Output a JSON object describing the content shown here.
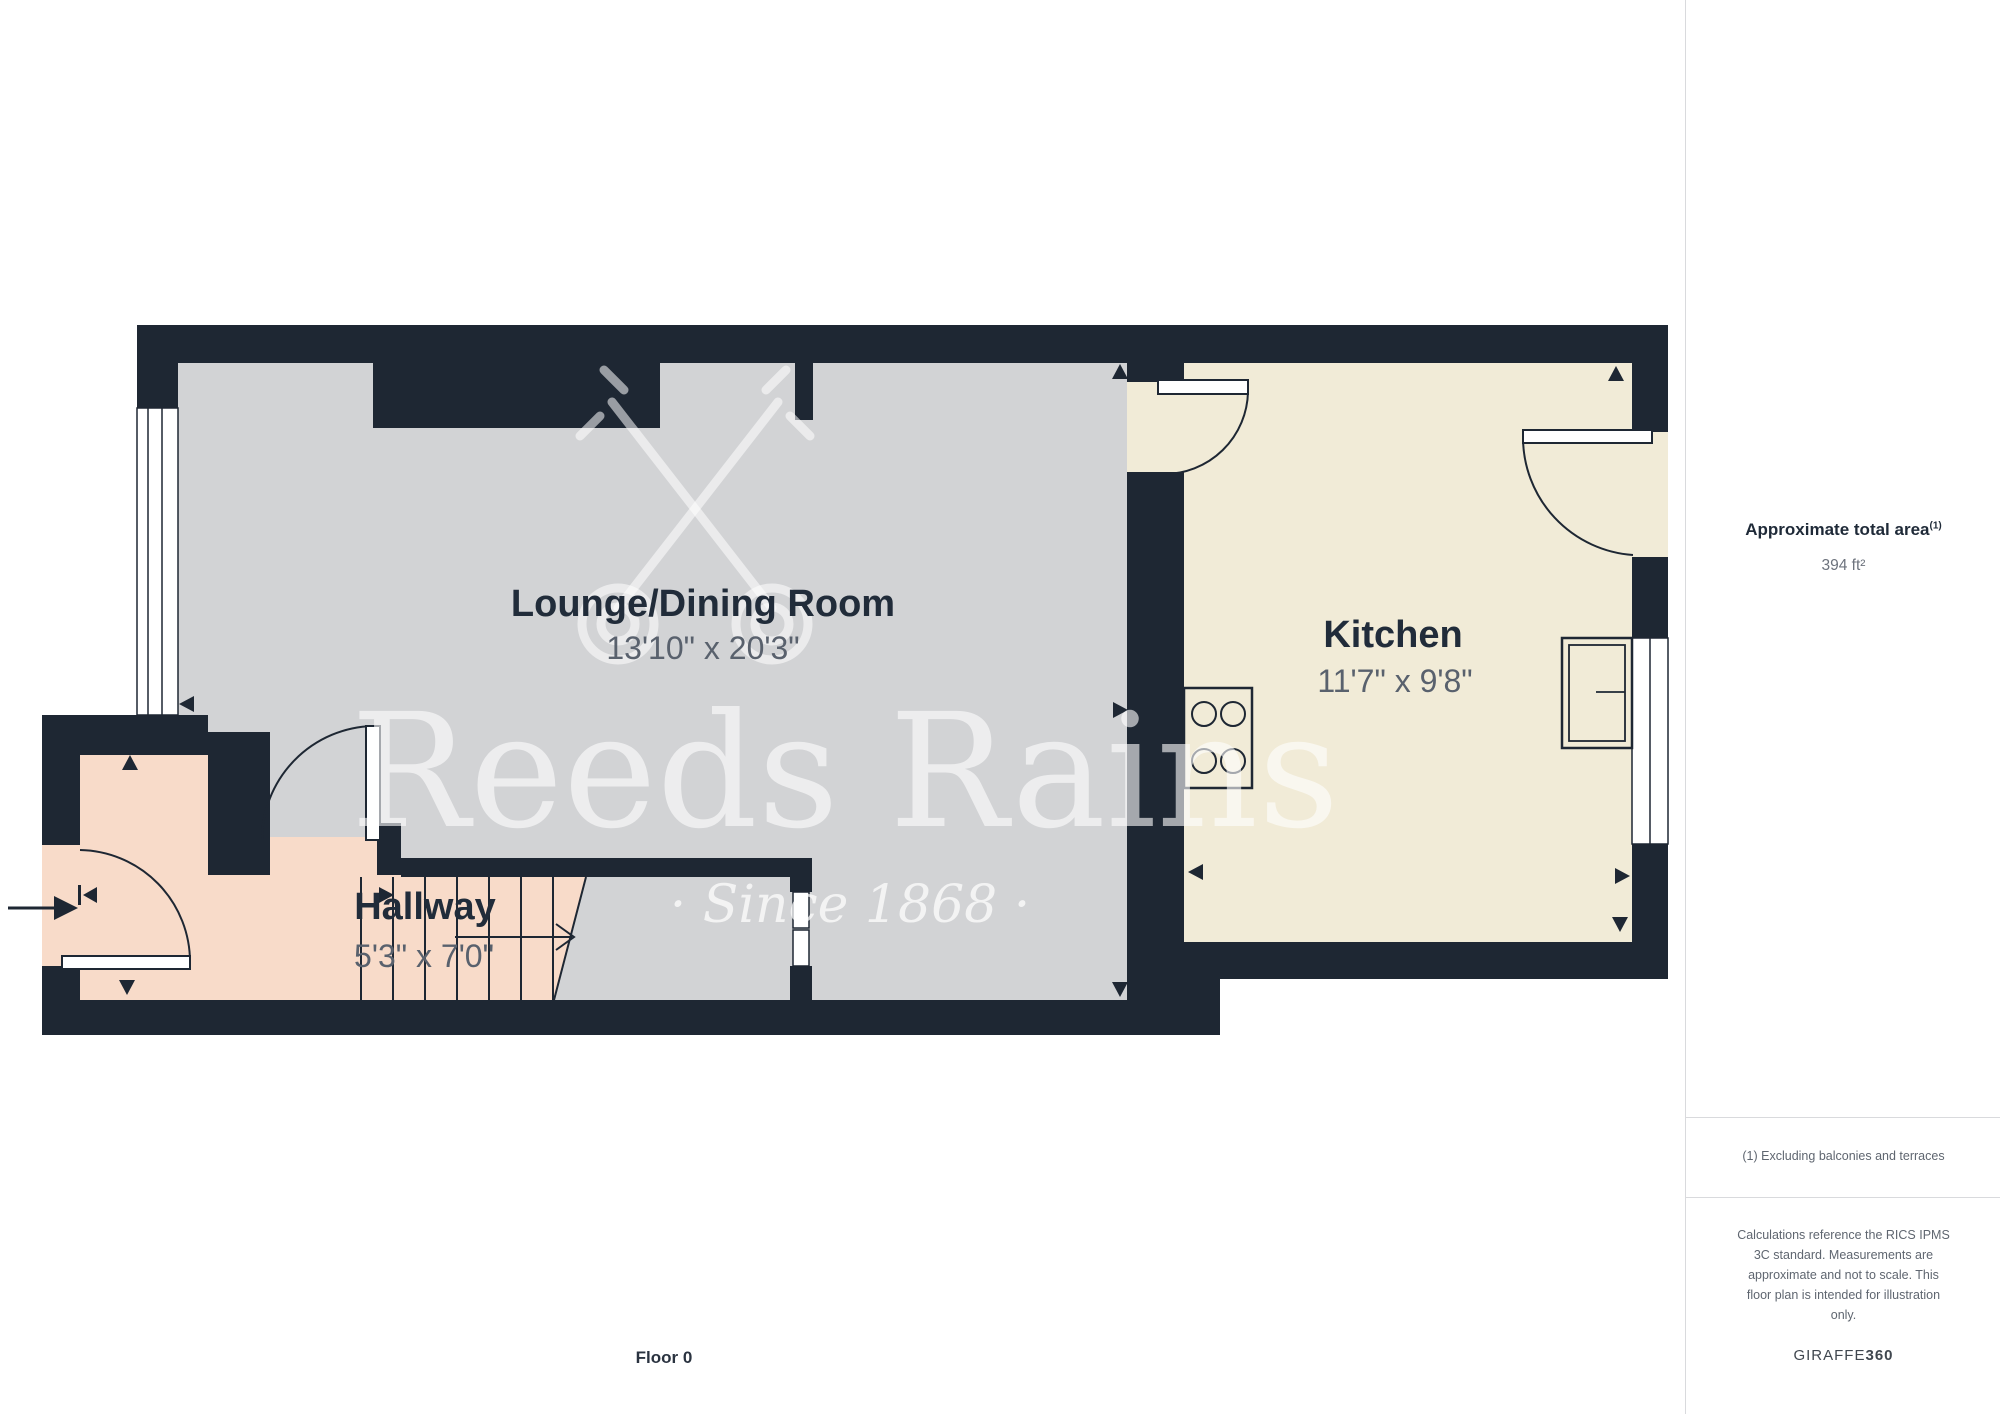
{
  "plan": {
    "floor_label": "Floor 0",
    "rooms": [
      {
        "name": "Lounge/Dining Room",
        "dims": "13'10\" x 20'3\""
      },
      {
        "name": "Kitchen",
        "dims": "11'7\" x 9'8\""
      },
      {
        "name": "Hallway",
        "dims": "5'3\" x 7'0\""
      }
    ],
    "colors": {
      "wall": "#1e2733",
      "lounge_floor": "#d2d3d5",
      "kitchen_floor": "#f1ebd7",
      "hallway_floor": "#f8dbc9",
      "label_text": "#212c3a",
      "dim_text": "#59616d"
    }
  },
  "watermark": {
    "brand": "Reeds Rains",
    "tagline": "· Since 1868 ·"
  },
  "sidebar": {
    "area_title": "Approximate total area",
    "area_title_sup": "(1)",
    "area_value": "394 ft²",
    "note": "(1) Excluding balconies and terraces",
    "disclaimer": "Calculations reference the RICS IPMS\n3C standard. Measurements are\napproximate and not to scale. This\nfloor plan is intended for illustration\nonly.",
    "brand_prefix": "GIRAFFE",
    "brand_suffix": "360"
  }
}
